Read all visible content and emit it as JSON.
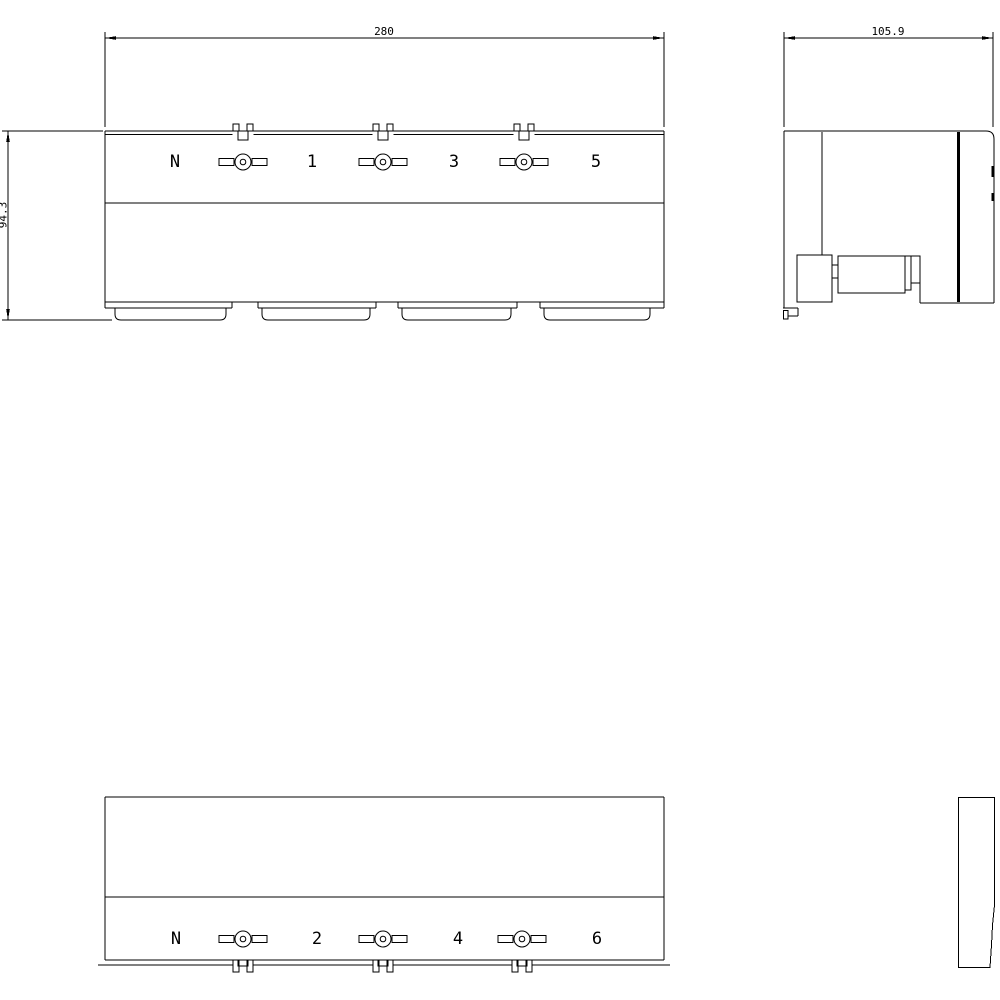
{
  "drawing": {
    "type": "technical-dimension-drawing",
    "colors": {
      "background": "#ffffff",
      "line": "#000000"
    },
    "front_view": {
      "dim_width": "280",
      "dim_height": "94.3",
      "terminal_labels": [
        "N",
        "1",
        "3",
        "5"
      ]
    },
    "side_view": {
      "dim_depth": "105.9"
    },
    "rear_view": {
      "terminal_labels": [
        "N",
        "2",
        "4",
        "6"
      ]
    },
    "icons": {
      "screw_terminal": "circle with clamp wings",
      "snap_notch": "double-ear rail notch",
      "mounting_foot": "rounded pan foot",
      "din_rail_clip": "stepped clip blocks"
    }
  }
}
